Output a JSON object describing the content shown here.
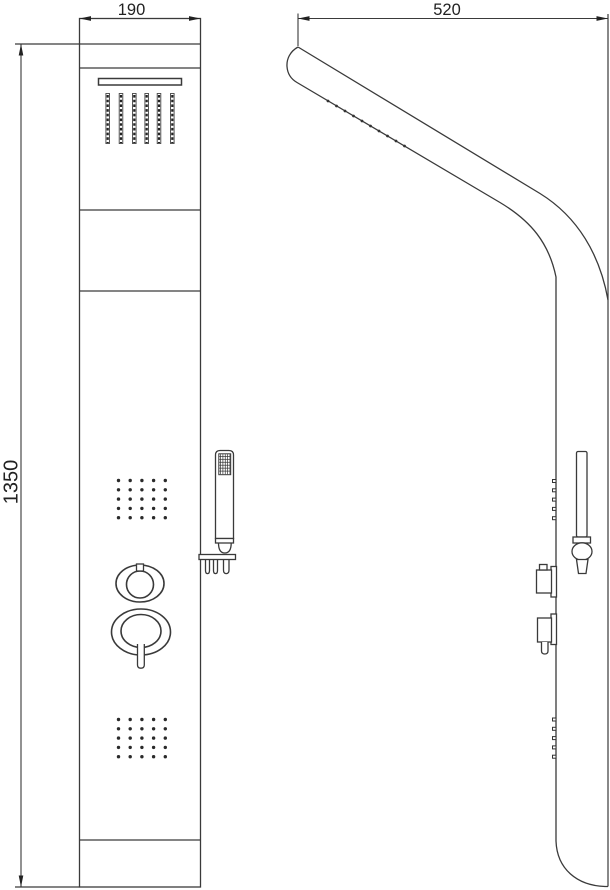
{
  "drawing": {
    "background_color": "#ffffff",
    "line_color": "#3a3a3a",
    "dimensions": {
      "width": {
        "label": "190"
      },
      "depth": {
        "label": "520"
      },
      "height": {
        "label": "1350"
      }
    },
    "views": {
      "front_view": {
        "parts": [
          "panel-outline",
          "panel-seams",
          "overhead-rain-slot",
          "rain-nozzle-columns",
          "upper-body-jet-grid",
          "hand-shower-with-holder",
          "round-diverter-knob",
          "mixer-knob-with-lever",
          "lower-body-jet-grid"
        ]
      },
      "side_view": {
        "parts": [
          "curved-head-profile",
          "head-spray-nozzles",
          "body-jet-nozzles",
          "hand-shower-profile",
          "knob-profiles",
          "rounded-bottom"
        ]
      }
    }
  }
}
